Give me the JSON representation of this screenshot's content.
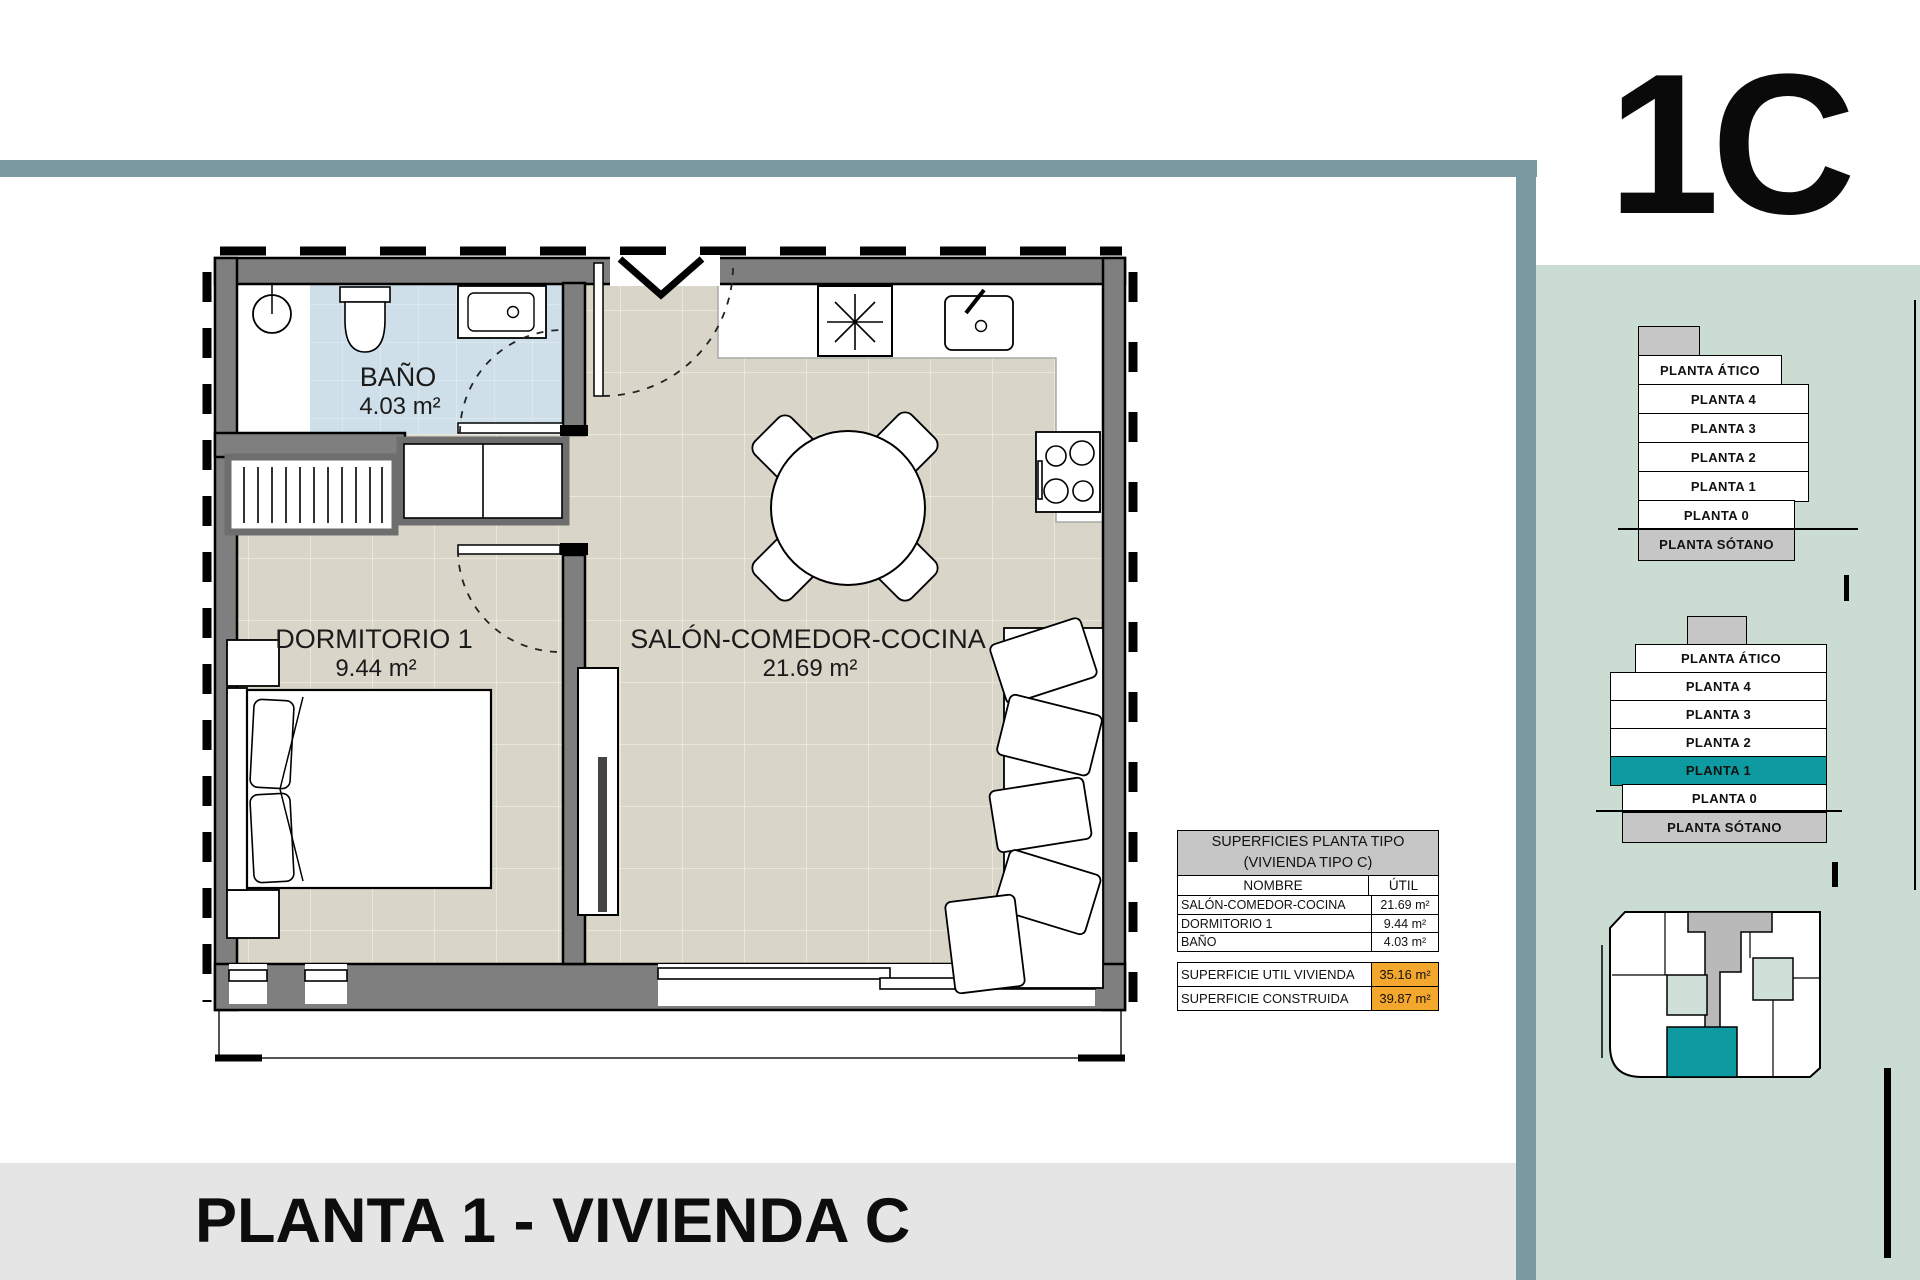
{
  "unit_label": "1C",
  "page_title": "PLANTA 1 - VIVIENDA C",
  "north_label": "N",
  "colors": {
    "frame": "#7a99a1",
    "panel_green": "#cbdcd2",
    "accent_teal": "#0d9aa1",
    "highlight_orange": "#f4a72d",
    "table_header_gray": "#c6c6c6",
    "floor_beige": "#d9d5c9",
    "bath_blue": "#cfdfe9",
    "wall_gray": "#7f7f7f"
  },
  "plan": {
    "rooms": [
      {
        "name": "BAÑO",
        "area": "4.03 m²"
      },
      {
        "name": "DORMITORIO 1",
        "area": "9.44 m²"
      },
      {
        "name": "SALÓN-COMEDOR-COCINA",
        "area": "21.69 m²"
      }
    ]
  },
  "surfaces_table": {
    "title_line1": "SUPERFICIES PLANTA TIPO",
    "title_line2": "(VIVIENDA TIPO C)",
    "col_name": "NOMBRE",
    "col_util": "ÚTIL",
    "rows": [
      {
        "name": "SALÓN-COMEDOR-COCINA",
        "util": "21.69 m²"
      },
      {
        "name": "DORMITORIO 1",
        "util": "9.44 m²"
      },
      {
        "name": "BAÑO",
        "util": "4.03 m²"
      }
    ],
    "totals": [
      {
        "label": "SUPERFICIE UTIL VIVIENDA",
        "value": "35.16 m²"
      },
      {
        "label": "SUPERFICIE CONSTRUIDA",
        "value": "39.87 m²"
      }
    ]
  },
  "diagrams": {
    "b1": {
      "floors": [
        "PLANTA ÁTICO",
        "PLANTA 4",
        "PLANTA 3",
        "PLANTA 2",
        "PLANTA 1",
        "PLANTA 0",
        "PLANTA SÓTANO"
      ]
    },
    "b2": {
      "floors": [
        "PLANTA ÁTICO",
        "PLANTA 4",
        "PLANTA 3",
        "PLANTA 2",
        "PLANTA 1",
        "PLANTA 0",
        "PLANTA SÓTANO"
      ],
      "highlighted_floor": "PLANTA 1"
    }
  },
  "scale_bar": {
    "labels": [
      "0",
      "1",
      "2 m"
    ]
  }
}
